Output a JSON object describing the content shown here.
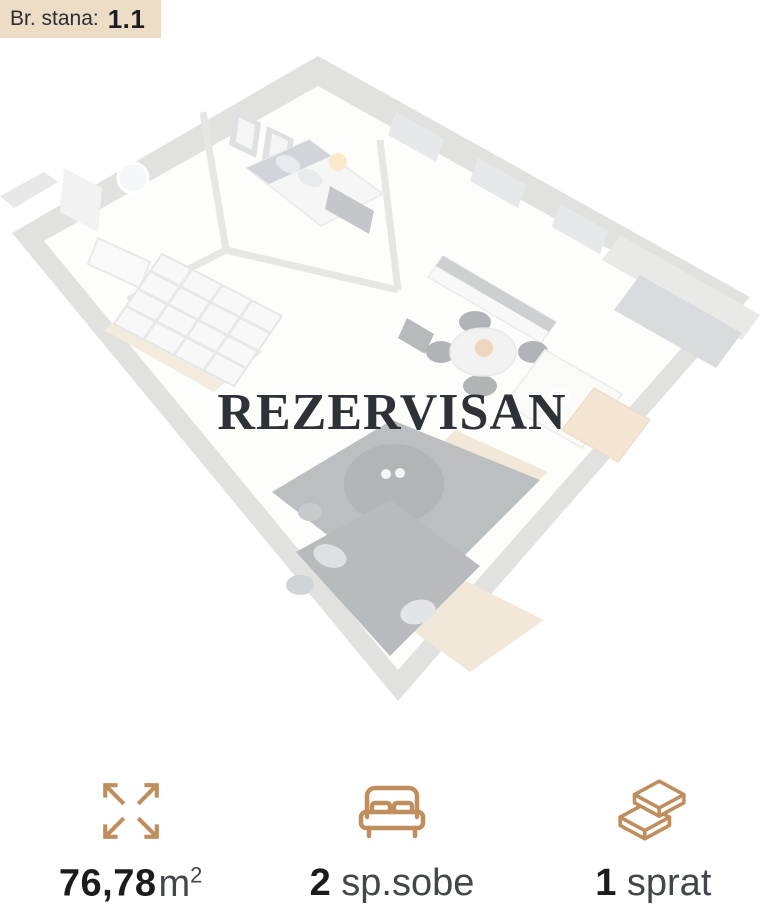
{
  "badge": {
    "label": "Br. stana:",
    "value": "1.1"
  },
  "watermark": "REZERVISAN",
  "floorplan": {
    "name": "apartment-3d-floorplan",
    "status": "reserved"
  },
  "stats": [
    {
      "name": "area",
      "icon": "expand-arrows-icon",
      "value": "76,78",
      "unit": "m",
      "unit_sup": "2"
    },
    {
      "name": "bedrooms",
      "icon": "bed-icon",
      "value": "2",
      "unit": "sp.sobe",
      "unit_sup": ""
    },
    {
      "name": "floor",
      "icon": "layers-icon",
      "value": "1",
      "unit": "sprat",
      "unit_sup": ""
    }
  ],
  "colors": {
    "accent": "#bf8e5c",
    "badge-bg": "#eeddc6",
    "watermark": "#2e3236",
    "value-text": "#1a1c1f",
    "unit-text": "#43474c"
  }
}
